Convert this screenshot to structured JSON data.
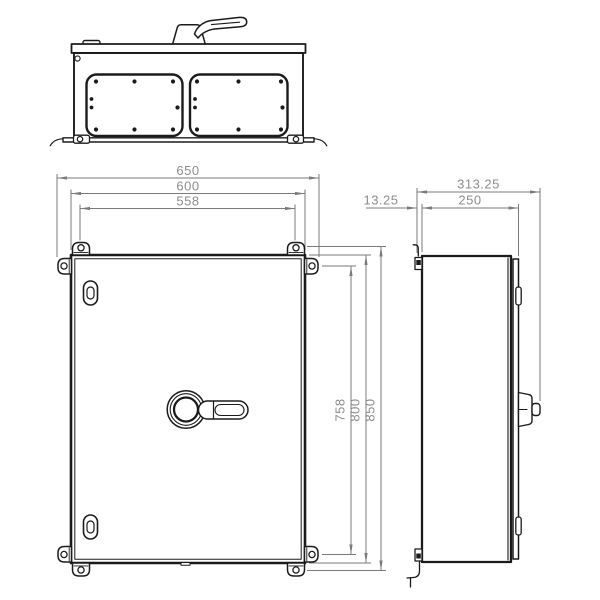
{
  "drawing": {
    "colors": {
      "background": "#ffffff",
      "object_line": "#1b1b1b",
      "dimension_line": "#7a7a7a",
      "dimension_text": "#8c8c8c"
    },
    "front_view": {
      "width_dims": {
        "overall": "650",
        "body": "600",
        "mounting": "558"
      },
      "height_dims": {
        "inner": "758",
        "body": "800",
        "mounting": "850"
      }
    },
    "side_view": {
      "depth_dims": {
        "overall": "313.25",
        "body": "250",
        "bracket": "13.25"
      }
    }
  }
}
